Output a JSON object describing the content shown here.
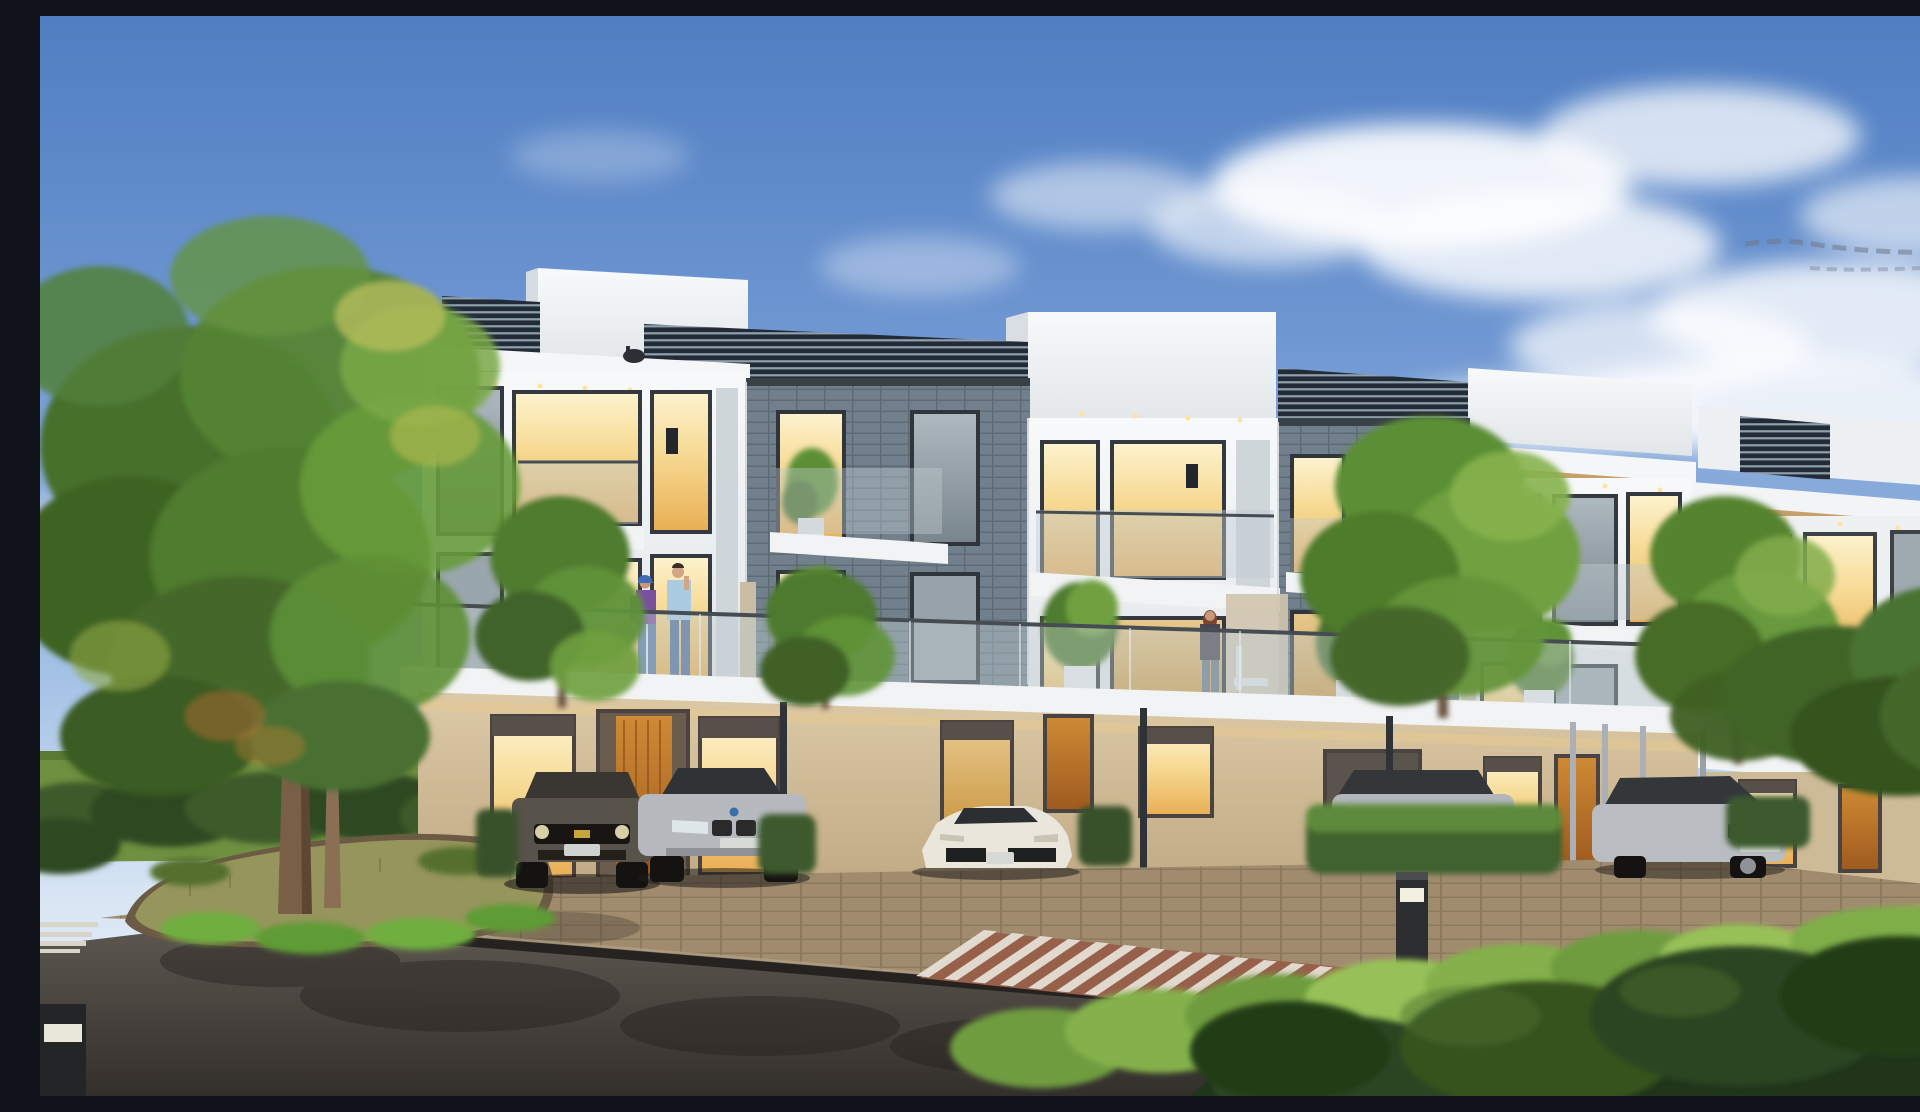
{
  "scene": {
    "type": "3d-architectural-exterior-rendering",
    "description": "Photorealistic rendering of a row of modern three-storey townhouses under a blue sky with soft clouds: white and grey-brick facades, rooftop louvre screens, glass balcony railings, warm lit interiors, timber entry doors, parked cars on a brick apron, a curving asphalt street with brick crosswalks, a planted island with trees, a street lamp and foreground hedges.",
    "storeys": 3,
    "units_visible": 6,
    "lighting": "daytime sky with warm interior lighting glowing from windows"
  },
  "sky": {
    "top_color": "#4f7ec2",
    "horizon_color": "#e8eff8",
    "clouds": "soft white cumulus, mainly centre and right",
    "dark_wisp": "thin grey streak near top right edge"
  },
  "building": {
    "style": "modern flat-roof townhouse row receding to the right",
    "facade_white": "#f2f4f5",
    "facade_brick_grey": "#71808c",
    "ground_floor_stucco": "#d6c3a0",
    "window_glow": "#f6d992",
    "door_timber": "#c9812f",
    "features": [
      "rooftop louvre screens",
      "white parapet towers",
      "timber soffits with recessed downlights",
      "glass balcony railings",
      "continuous first-floor balcony band",
      "floor-to-ceiling glazing",
      "black wall sconces",
      "security camera under left eave",
      "slim carport posts",
      "potted balcony trees"
    ]
  },
  "vehicles": [
    {
      "name": "dark grey muscle car, front view, gold bowtie grille badge, white plate",
      "color": "#57524a"
    },
    {
      "name": "silver coupe with twin-kidney grille, front view, white plate",
      "color": "#b6babf"
    },
    {
      "name": "white low wedge sports car, front view, white plate",
      "color": "#eae6dc"
    },
    {
      "name": "silver hatchback partly hidden behind hedge",
      "color": "#b3b7bb"
    },
    {
      "name": "silver coupe at three-quarter angle, right side",
      "color": "#b9bdc2"
    }
  ],
  "people": [
    {
      "name": "woman in purple top with blue cap and backpack",
      "location": "left first-floor balcony"
    },
    {
      "name": "man in light-blue shirt and jeans drinking",
      "location": "left first-floor balcony"
    },
    {
      "name": "woman in dark top with auburn hair",
      "location": "centre-right balcony beside white chair"
    },
    {
      "name": "person in white shirt",
      "location": "far-right balcony behind glass railing"
    }
  ],
  "vegetation": {
    "left_large_tree": "tall green tree with yellow-green highlights in front of left building edge",
    "island_planting": "olive grass mound with two slim trunks and bright green fringe",
    "right_trees": "sunlit green trees between and behind right-hand units",
    "balcony_planters": "small trees in white cube pots on balconies",
    "base_hedges": "clipped hedges between parking bays",
    "foreground_hedge": "large dark hedge across bottom right with sunlit bright top"
  },
  "street": {
    "road_surface": "dark asphalt curving around planted island with tree shadows",
    "apron": "brown brick-paver parking apron in front of the houses",
    "crosswalk_centre": "white striped crossing on red-brick band",
    "crosswalk_left": "partial white striped crossing at far left edge",
    "street_lamp": "curved-arm grey street lamp at upper left",
    "bollards": 2,
    "kerb": "dark gutter line between apron and asphalt"
  },
  "palette": {
    "asphalt": "#3b3733",
    "paver": "#a08b6e",
    "crosswalk_brick": "#96604a",
    "hedge_dark": "#20351a",
    "hedge_sunlit": "#84b14c",
    "lawn": "#6e9040",
    "grass_olive": "#96955c",
    "trunk": "#7a5f47",
    "glass_railing": "#c2ccd2"
  }
}
